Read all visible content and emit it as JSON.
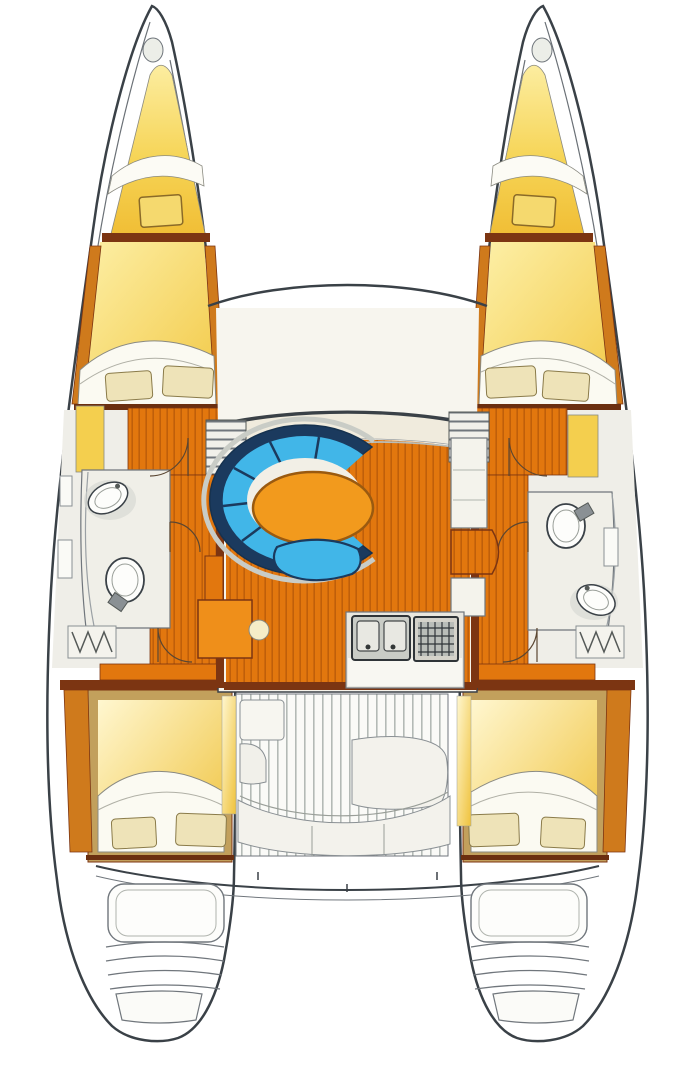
{
  "figure": {
    "type": "floorplan-diagram",
    "subject": "catamaran-sailboat-interior-deck-plan"
  },
  "colors": {
    "outline": "#3a4147",
    "hull_white": "#ffffff",
    "deck_cream": "#f6f3ea",
    "dashboard_cream": "#f0ebdd",
    "cabin_yellow": "#f4cf4e",
    "cabin_yellow_deep": "#f0bd34",
    "cabin_yellow_pale": "#fdf0a8",
    "wood_floor": "#e2770e",
    "wood_stripe": "#bf5f0a",
    "wood_dark": "#7c3512",
    "wood_trim": "#cf7a1c",
    "sofa_navy": "#1b3a5e",
    "sofa_blue": "#41b6e8",
    "rim_silver": "#c9ccc6",
    "table_orange": "#f29a1d",
    "table_edge": "#9a5a10",
    "bath_floor": "#f0efe8",
    "fixture_white": "#fdfdfb",
    "fixture_grey": "#c9ccc6",
    "steel_grey": "#8a9094",
    "pillow_cream": "#eee3b8",
    "bed_sheet": "#fbfaf2",
    "bench_white": "#f3f2ec",
    "frame_tan": "#c2a05c",
    "line_grey": "#70767c",
    "stove_dark": "#2f3438"
  },
  "fixtures": [
    "port-hull",
    "starboard-hull",
    "trampoline-foredeck",
    "forward-crossbeam",
    "forepeak-locker",
    "forward-double-berth",
    "pillows",
    "head-sink",
    "head-toilet",
    "companionway-stairs",
    "cabin-doors",
    "salon",
    "c-shaped-dinette-sofa",
    "dinette-table",
    "dinette-stool",
    "nav-table",
    "galley-double-sink",
    "galley-stove",
    "galley-counters",
    "aft-double-berth",
    "cockpit-slatted-floor",
    "cockpit-bench",
    "cockpit-table",
    "transom-swim-steps",
    "aft-deck-beam"
  ]
}
